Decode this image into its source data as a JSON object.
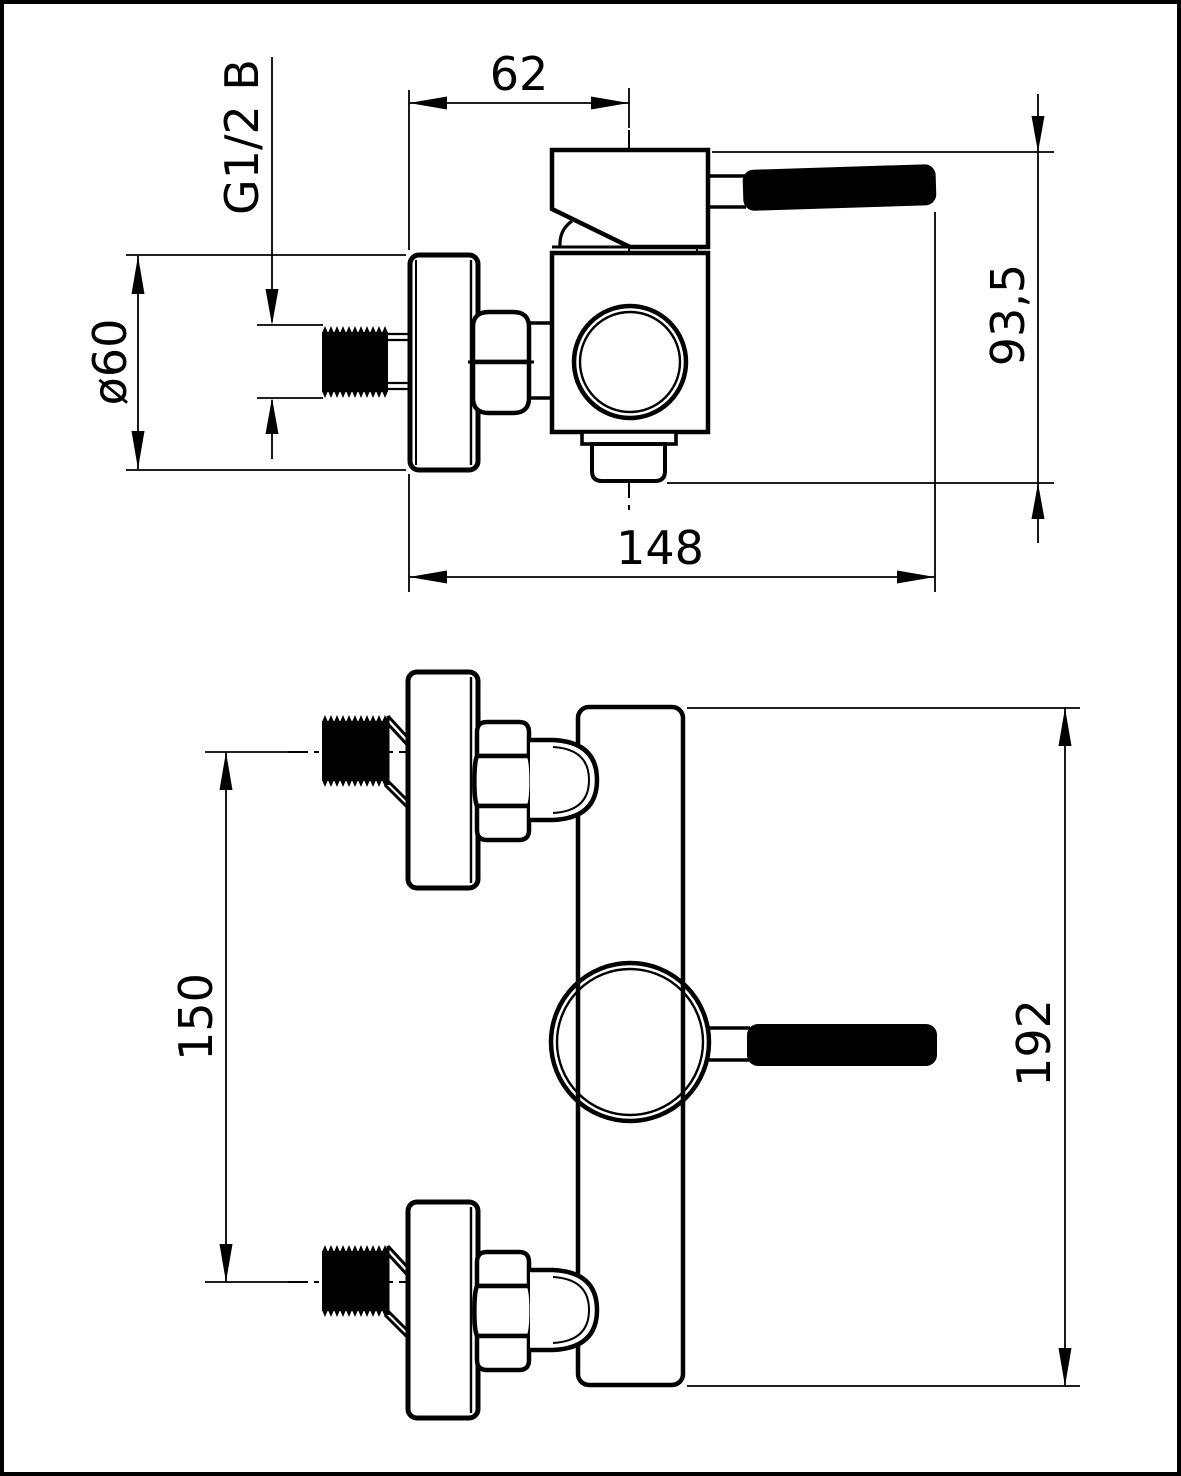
{
  "drawing": {
    "type": "technical-drawing",
    "subject": "wall-mounted shower mixer tap, two orthographic views",
    "background": "#ffffff",
    "line_color": "#000000",
    "labels": {
      "dim_62": "62",
      "dim_thread": "G1/2 B",
      "dim_diameter": "ø60",
      "dim_93_5": "93,5",
      "dim_148": "148",
      "dim_150": "150",
      "dim_192": "192"
    }
  }
}
